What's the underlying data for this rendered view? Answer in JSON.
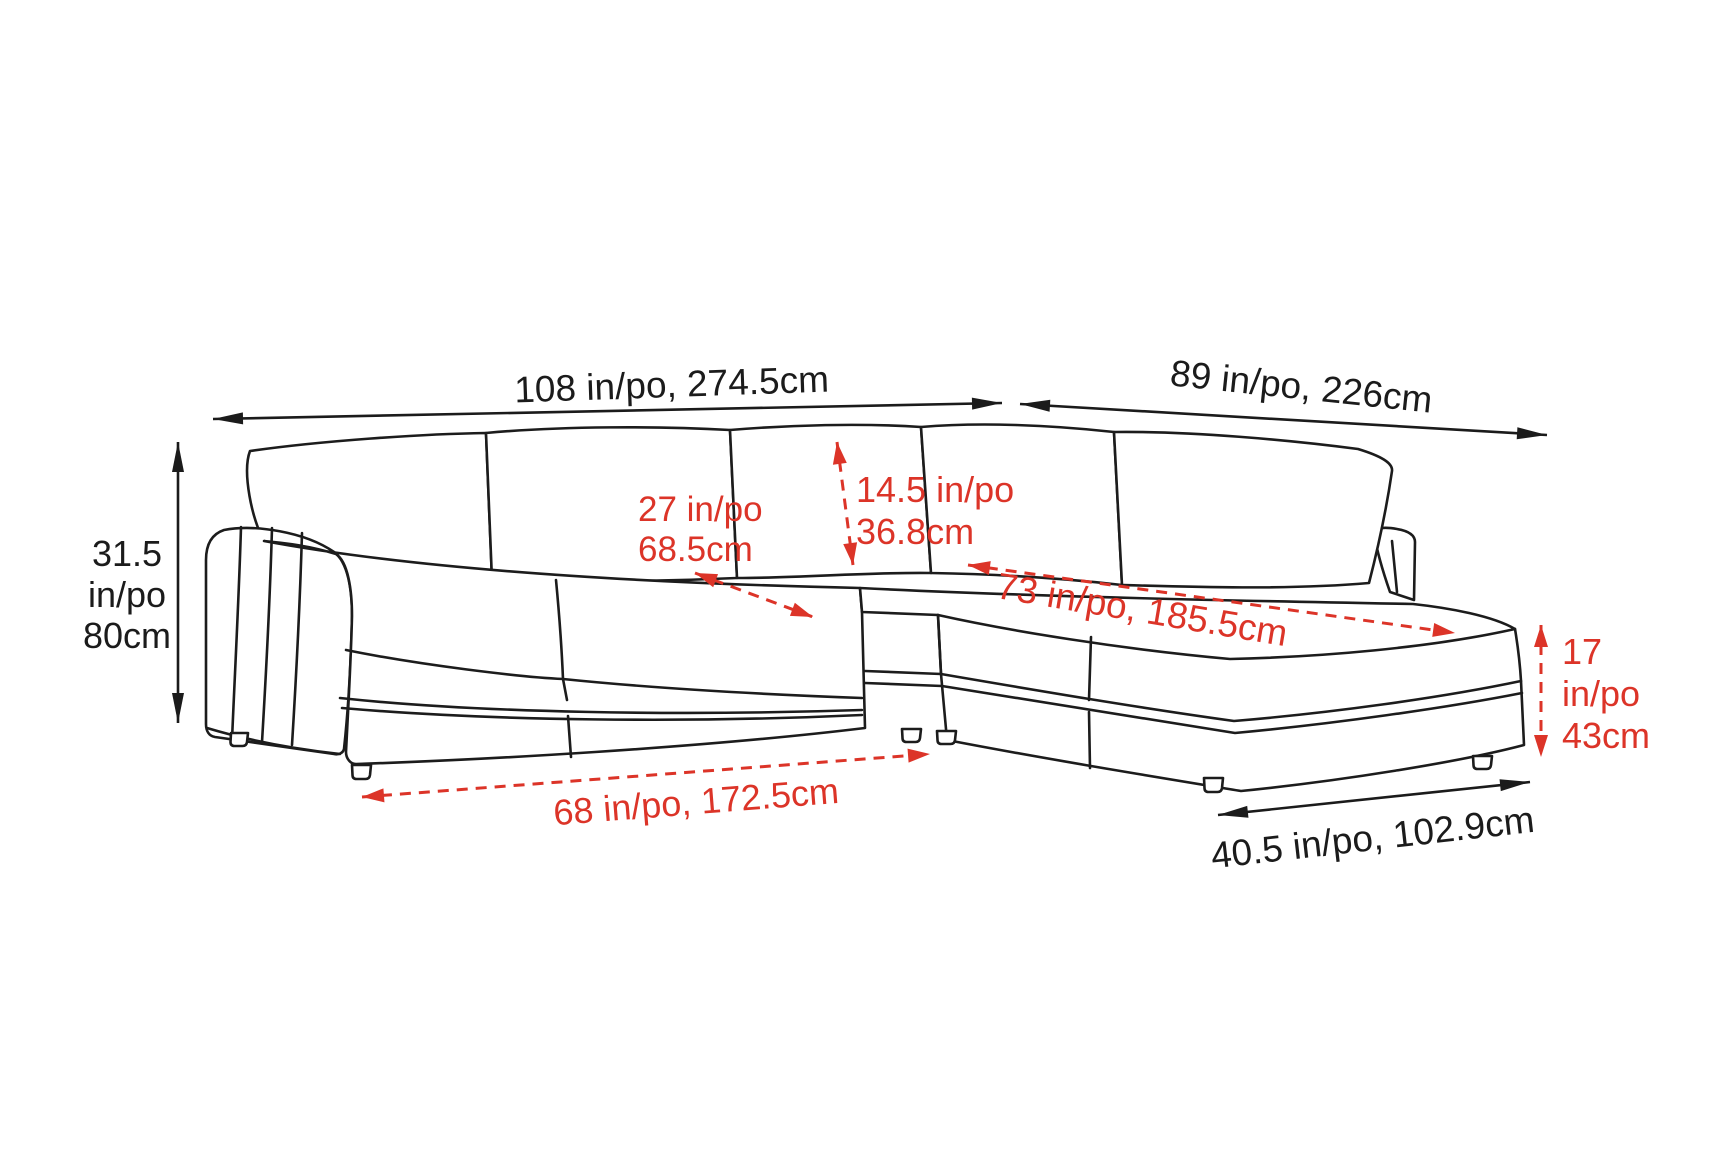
{
  "figure": {
    "title": "Sectional sofa dimension diagram",
    "subject": "L-shaped sectional sofa with left arm and right chaise, isometric line drawing",
    "units_note": "in/po = inches/pouces, cm = centimetres"
  },
  "colors": {
    "background": "#ffffff",
    "outline": "#1c1c1c",
    "dimension_black": "#1b1b1b",
    "dimension_red": "#dc3428"
  },
  "annotations": [
    {
      "id": "overall-width",
      "meaning": "overall sofa width",
      "color": "black",
      "dashed": false,
      "line": {
        "x1": 213,
        "y1": 419,
        "x2": 1002,
        "y2": 403
      },
      "label": {
        "lines": [
          "108 in/po, 274.5cm"
        ],
        "x": 672,
        "y": 397,
        "rotate": -2,
        "anchor": "middle",
        "size": 37,
        "lineHeight": 41
      }
    },
    {
      "id": "return-width",
      "meaning": "chaise side overall length",
      "color": "black",
      "dashed": false,
      "line": {
        "x1": 1020,
        "y1": 404,
        "x2": 1547,
        "y2": 435
      },
      "label": {
        "lines": [
          "89 in/po, 226cm"
        ],
        "x": 1300,
        "y": 399,
        "rotate": 6,
        "anchor": "middle",
        "size": 37,
        "lineHeight": 41
      }
    },
    {
      "id": "overall-height",
      "meaning": "overall back height",
      "color": "black",
      "dashed": false,
      "line": {
        "x1": 178,
        "y1": 442,
        "x2": 178,
        "y2": 723
      },
      "label": {
        "lines": [
          "31.5",
          "in/po",
          "80cm"
        ],
        "x": 127,
        "y": 566,
        "rotate": 0,
        "anchor": "middle",
        "size": 36,
        "lineHeight": 41
      }
    },
    {
      "id": "seat-depth",
      "meaning": "seat depth",
      "color": "red",
      "dashed": true,
      "line": {
        "x1": 695,
        "y1": 573,
        "x2": 813,
        "y2": 617
      },
      "label": {
        "lines": [
          "27 in/po",
          "68.5cm"
        ],
        "x": 638,
        "y": 521,
        "rotate": 0,
        "anchor": "start",
        "size": 35,
        "lineHeight": 40
      }
    },
    {
      "id": "back-cushion-height",
      "meaning": "back cushion height",
      "color": "red",
      "dashed": true,
      "line": {
        "x1": 837,
        "y1": 442,
        "x2": 853,
        "y2": 565
      },
      "label": {
        "lines": [
          "14.5 in/po",
          "36.8cm"
        ],
        "x": 856,
        "y": 502,
        "rotate": 0,
        "anchor": "start",
        "size": 36,
        "lineHeight": 42
      }
    },
    {
      "id": "chaise-length",
      "meaning": "chaise seating length",
      "color": "red",
      "dashed": true,
      "line": {
        "x1": 968,
        "y1": 565,
        "x2": 1455,
        "y2": 633
      },
      "label": {
        "lines": [
          "73 in/po, 185.5cm"
        ],
        "x": 1140,
        "y": 622,
        "rotate": 9.5,
        "anchor": "middle",
        "size": 37,
        "lineHeight": 41
      }
    },
    {
      "id": "seat-height",
      "meaning": "seat height from floor",
      "color": "red",
      "dashed": true,
      "line": {
        "x1": 1541,
        "y1": 625,
        "x2": 1541,
        "y2": 757
      },
      "label": {
        "lines": [
          "17",
          "in/po",
          "43cm"
        ],
        "x": 1562,
        "y": 664,
        "rotate": 0,
        "anchor": "start",
        "size": 36,
        "lineHeight": 42
      }
    },
    {
      "id": "seat-front-width",
      "meaning": "seat width without arm",
      "color": "red",
      "dashed": true,
      "line": {
        "x1": 362,
        "y1": 797,
        "x2": 930,
        "y2": 754
      },
      "label": {
        "lines": [
          "68 in/po, 172.5cm"
        ],
        "x": 697,
        "y": 814,
        "rotate": -4.5,
        "anchor": "middle",
        "size": 36,
        "lineHeight": 41
      }
    },
    {
      "id": "chaise-depth",
      "meaning": "chaise width / depth of return",
      "color": "black",
      "dashed": false,
      "line": {
        "x1": 1218,
        "y1": 815,
        "x2": 1530,
        "y2": 782
      },
      "label": {
        "lines": [
          "40.5 in/po, 102.9cm"
        ],
        "x": 1374,
        "y": 850,
        "rotate": -6.5,
        "anchor": "middle",
        "size": 37,
        "lineHeight": 41
      }
    }
  ]
}
